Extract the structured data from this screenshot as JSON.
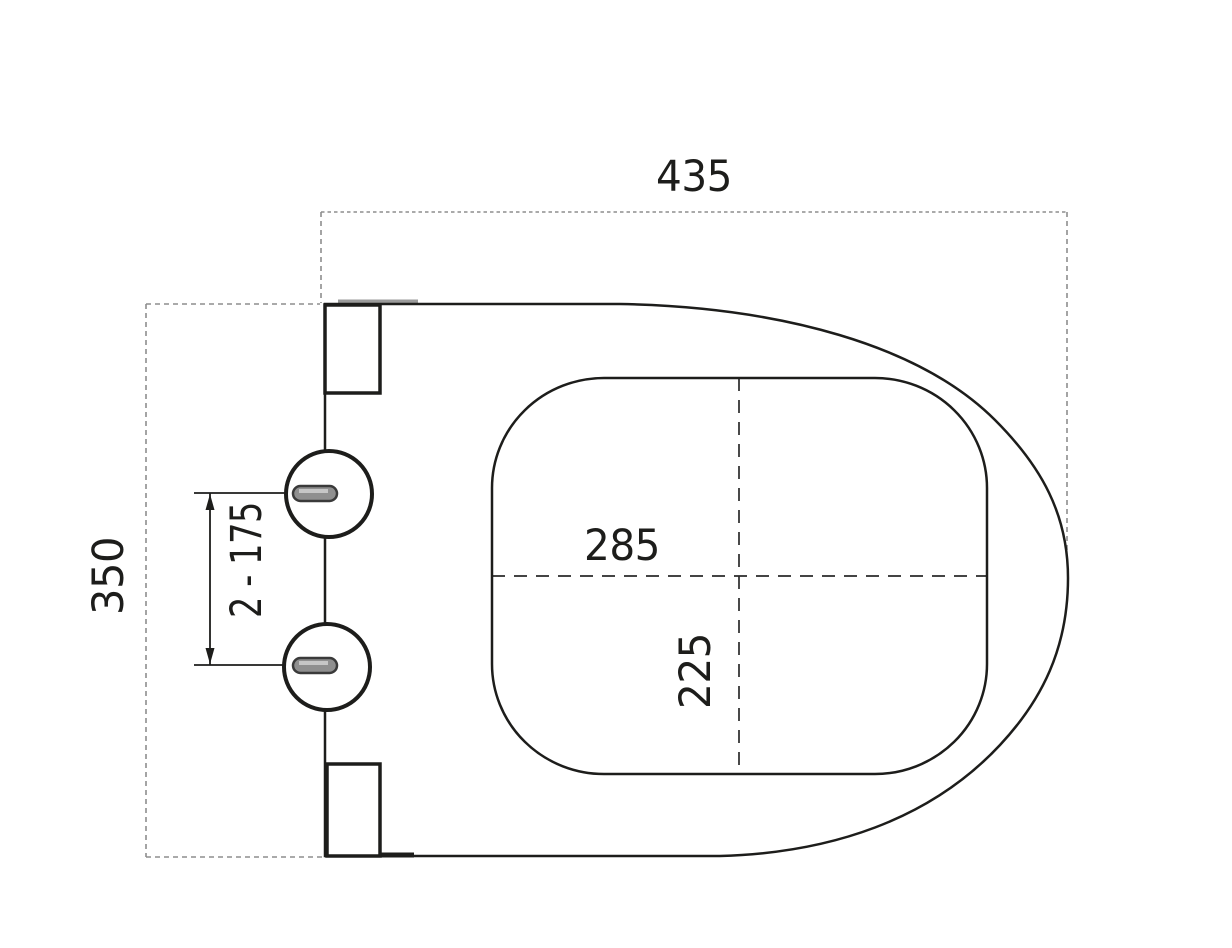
{
  "drawing": {
    "labels": {
      "overall_width": "435",
      "overall_depth": "350",
      "hinge_spacing": "2 - 175",
      "opening_width": "285",
      "opening_depth": "225"
    },
    "colors": {
      "background": "#ffffff",
      "line": "#1d1d1b",
      "guide": "#8d8d8d",
      "centerline": "#2a2a2a",
      "artifact_gray": "#9b9b9b",
      "slot_fill": "#8f8f8f",
      "slot_stroke": "#3a3a3a",
      "slot_highlight": "#c6c6c6"
    }
  }
}
